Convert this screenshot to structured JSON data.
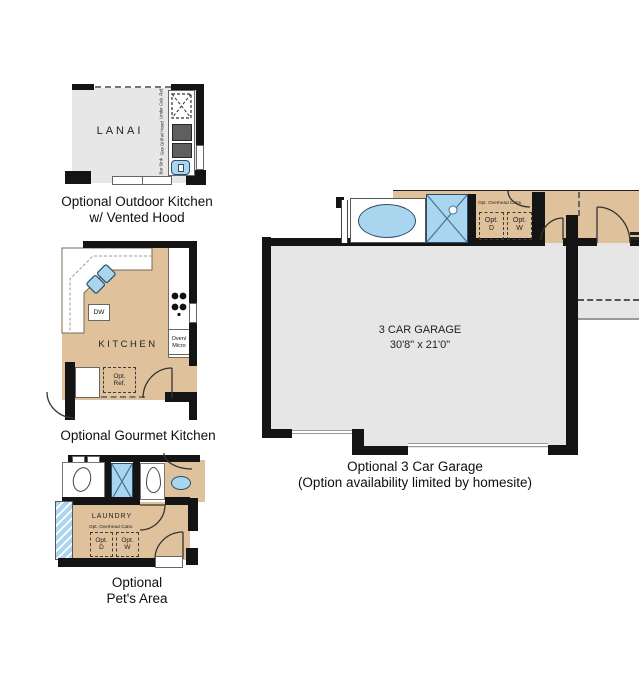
{
  "colors": {
    "wall": "#141414",
    "floor_gray": "#e7e7e7",
    "floor_tan": "#dfc29c",
    "fixture_blue": "#a9d5ee",
    "fixture_blue_dark": "#2b4d6d",
    "grill_gray": "#5f5f5f"
  },
  "outdoor_kitchen": {
    "room_label": "LANAI",
    "under_cab_ref_label": "Under Cab. Ref.",
    "gas_grill_label": "Gas Grill w/ Hood",
    "bar_sink_label": "Bar Sink",
    "caption_line1": "Optional Outdoor Kitchen",
    "caption_line2": "w/ Vented Hood"
  },
  "gourmet_kitchen": {
    "room_label": "KITCHEN",
    "dishwasher_label": "DW",
    "oven_line1": "Oven/",
    "oven_line2": "Micro",
    "ref_line1": "Opt.",
    "ref_line2": "Ref.",
    "caption": "Optional Gourmet Kitchen"
  },
  "pets_area": {
    "room_label": "LAUNDRY",
    "overhead_cabs_label": "Opt. Overhead Cabs.",
    "dryer_line1": "Opt.",
    "dryer_line2": "D",
    "washer_line1": "Opt.",
    "washer_line2": "W",
    "caption_line1": "Optional",
    "caption_line2": "Pet's Area"
  },
  "garage": {
    "room_label": "3 CAR GARAGE",
    "dimensions": "30'8\" x 21'0\"",
    "overhead_cabs_label": "Opt. Overhead Cabs.",
    "dryer_line1": "Opt.",
    "dryer_line2": "D",
    "washer_line1": "Opt.",
    "washer_line2": "W",
    "caption_line1": "Optional 3 Car Garage",
    "caption_line2": "(Option availability limited by homesite)"
  }
}
